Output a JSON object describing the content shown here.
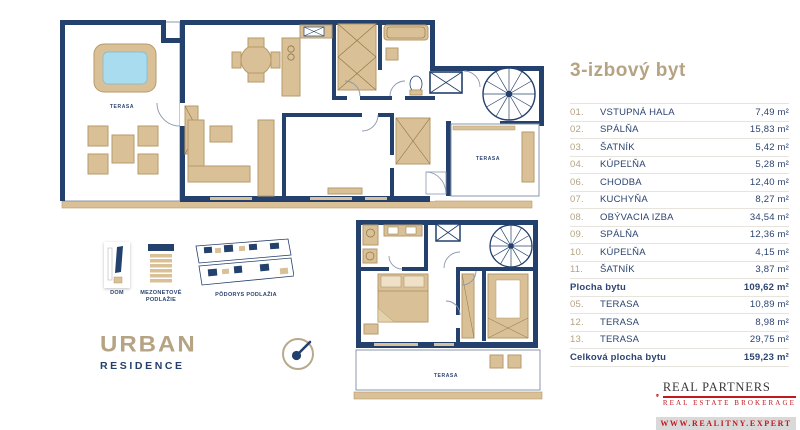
{
  "panel": {
    "title": "3-izbový byt",
    "rows": [
      {
        "num": "01.",
        "label": "VSTUPNÁ HALA",
        "value": "7,49 m²"
      },
      {
        "num": "02.",
        "label": "SPÁLŇA",
        "value": "15,83 m²"
      },
      {
        "num": "03.",
        "label": "ŠATNÍK",
        "value": "5,42 m²"
      },
      {
        "num": "04.",
        "label": "KÚPEĽŇA",
        "value": "5,28 m²"
      },
      {
        "num": "06.",
        "label": "CHODBA",
        "value": "12,40 m²"
      },
      {
        "num": "07.",
        "label": "KUCHYŇA",
        "value": "8,27 m²"
      },
      {
        "num": "08.",
        "label": "OBÝVACIA IZBA",
        "value": "34,54 m²"
      },
      {
        "num": "09.",
        "label": "SPÁLŇA",
        "value": "12,36 m²"
      },
      {
        "num": "10.",
        "label": "KÚPEĽŇA",
        "value": "4,15 m²"
      },
      {
        "num": "11.",
        "label": "ŠATNÍK",
        "value": "3,87 m²"
      },
      {
        "num": "",
        "label": "Plocha bytu",
        "value": "109,62 m²"
      },
      {
        "num": "05.",
        "label": "TERASA",
        "value": "10,89 m²"
      },
      {
        "num": "12.",
        "label": "TERASA",
        "value": "8,98 m²"
      },
      {
        "num": "13.",
        "label": "TERASA",
        "value": "29,75 m²"
      },
      {
        "num": "",
        "label": "Celková plocha bytu",
        "value": "159,23 m²"
      }
    ]
  },
  "plan": {
    "terrace_label": "TERASA"
  },
  "legend": {
    "dom": "DOM",
    "mezonet": "MEZONETOVÉ PODLAŽIE",
    "podorys": "PÔDORYS PODLAŽIA"
  },
  "brand": {
    "urban": "URBAN",
    "residence": "RESIDENCE"
  },
  "realtor": {
    "initials": "REB",
    "name": "REAL PARTNERS",
    "tagline": "REAL ESTATE BROKERAGE",
    "website": "WWW.REALITNY.EXPERT"
  },
  "colors": {
    "navy": "#24406c",
    "accent_tan": "#b5a383",
    "furniture_tan": "#d9c096",
    "pool_blue": "#a9dcef",
    "logo_red": "#c0191f"
  }
}
